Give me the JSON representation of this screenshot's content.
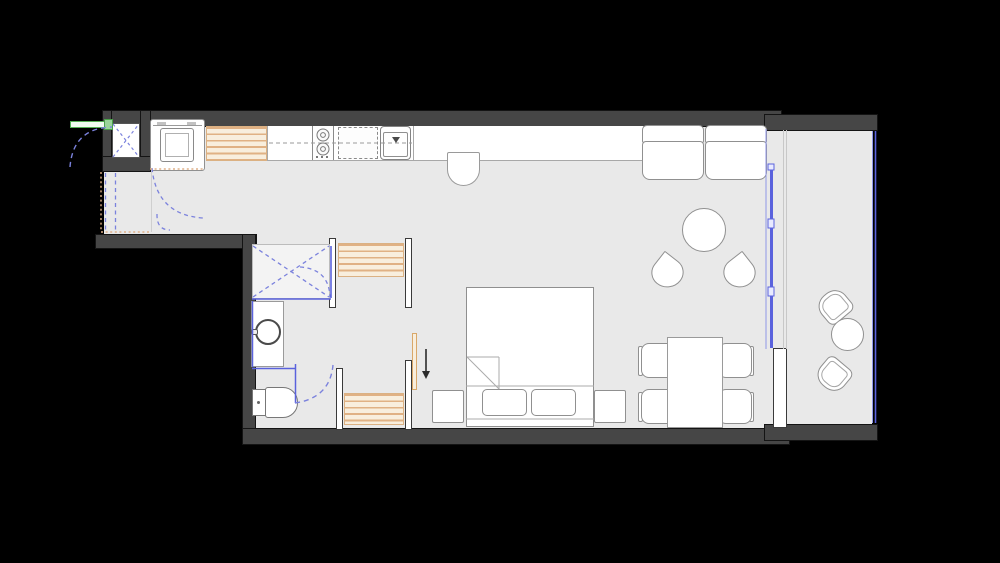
{
  "document": {
    "type": "architectural floor plan",
    "subject": "studio apartment with balcony",
    "visible_text": "",
    "canvas": {
      "width": 1000,
      "height": 563
    }
  },
  "palette": {
    "background": "#000000",
    "exterior_wall": "#464646",
    "interior_wall_fill": "#ffffff",
    "floor": "#e9e9e9",
    "furniture_fill": "#ffffff",
    "furniture_outline": "#909090",
    "wood_slat_stripe": "#e0b184",
    "wood_slat_bg": "#f8eedd",
    "door_swing_dash": "#7b82dd",
    "glass_wall": "#5a62dd",
    "entry_door_green": "#55b055",
    "threshold_orange": "#dfb088",
    "arrow": "#2b2b2b"
  },
  "rooms": [
    {
      "id": "entry",
      "label": "Entry hall"
    },
    {
      "id": "kitchen",
      "label": "Kitchen"
    },
    {
      "id": "living",
      "label": "Living and dining area"
    },
    {
      "id": "sleeping",
      "label": "Sleeping area"
    },
    {
      "id": "bathroom",
      "label": "Bathroom with shower"
    },
    {
      "id": "balcony",
      "label": "Balcony"
    }
  ],
  "elements": {
    "entry_door": {
      "label": "Entry door with swing arc"
    },
    "shaft": {
      "label": "Shaft / duct with cross marking"
    },
    "washing_machine": {
      "label": "Washing machine"
    },
    "kitchen_cabinet": {
      "label": "Slatted kitchen tall cabinet"
    },
    "counter": {
      "label": "Kitchen counter run"
    },
    "cooktop": {
      "label": "Two-burner cooktop"
    },
    "dishwasher": {
      "label": "Built-under appliance (dashed)"
    },
    "kitchen_sink": {
      "label": "Kitchen sink"
    },
    "counter_stool": {
      "label": "Counter stool"
    },
    "sofa": {
      "label": "Two-seat sofa"
    },
    "coffee_table": {
      "label": "Round coffee table"
    },
    "lounge_chair_left": {
      "label": "Petal lounge chair (left)"
    },
    "lounge_chair_right": {
      "label": "Petal lounge chair (right)"
    },
    "dining_table": {
      "label": "Dining table for four"
    },
    "dining_chair_1": {
      "label": "Dining chair"
    },
    "dining_chair_2": {
      "label": "Dining chair"
    },
    "dining_chair_3": {
      "label": "Dining chair"
    },
    "dining_chair_4": {
      "label": "Dining chair"
    },
    "bed": {
      "label": "Double bed with pillows and folded blanket"
    },
    "nightstand_left": {
      "label": "Nightstand"
    },
    "nightstand_right": {
      "label": "Nightstand"
    },
    "wardrobe_hall": {
      "label": "Slatted wardrobe (hall side)"
    },
    "wardrobe_bedroom": {
      "label": "Slatted wardrobe (bedroom side)"
    },
    "sliding_panel": {
      "label": "Sliding door panel"
    },
    "shower": {
      "label": "Shower enclosure with glass door"
    },
    "bathroom_sink": {
      "label": "Washbasin on vanity"
    },
    "toilet": {
      "label": "Toilet"
    },
    "bathroom_door": {
      "label": "Bathroom door swing"
    },
    "entrance_arrow": {
      "label": "Circulation direction arrow"
    },
    "glass_wall": {
      "label": "Glazed sliding wall to balcony"
    },
    "balcony_railing": {
      "label": "Balcony glass railing"
    },
    "balcony_wall_pier": {
      "label": "Facade wall pier"
    },
    "balcony_table": {
      "label": "Round balcony table"
    },
    "balcony_chair_upper": {
      "label": "Balcony tub chair (upper)"
    },
    "balcony_chair_lower": {
      "label": "Balcony tub chair (lower)"
    }
  }
}
